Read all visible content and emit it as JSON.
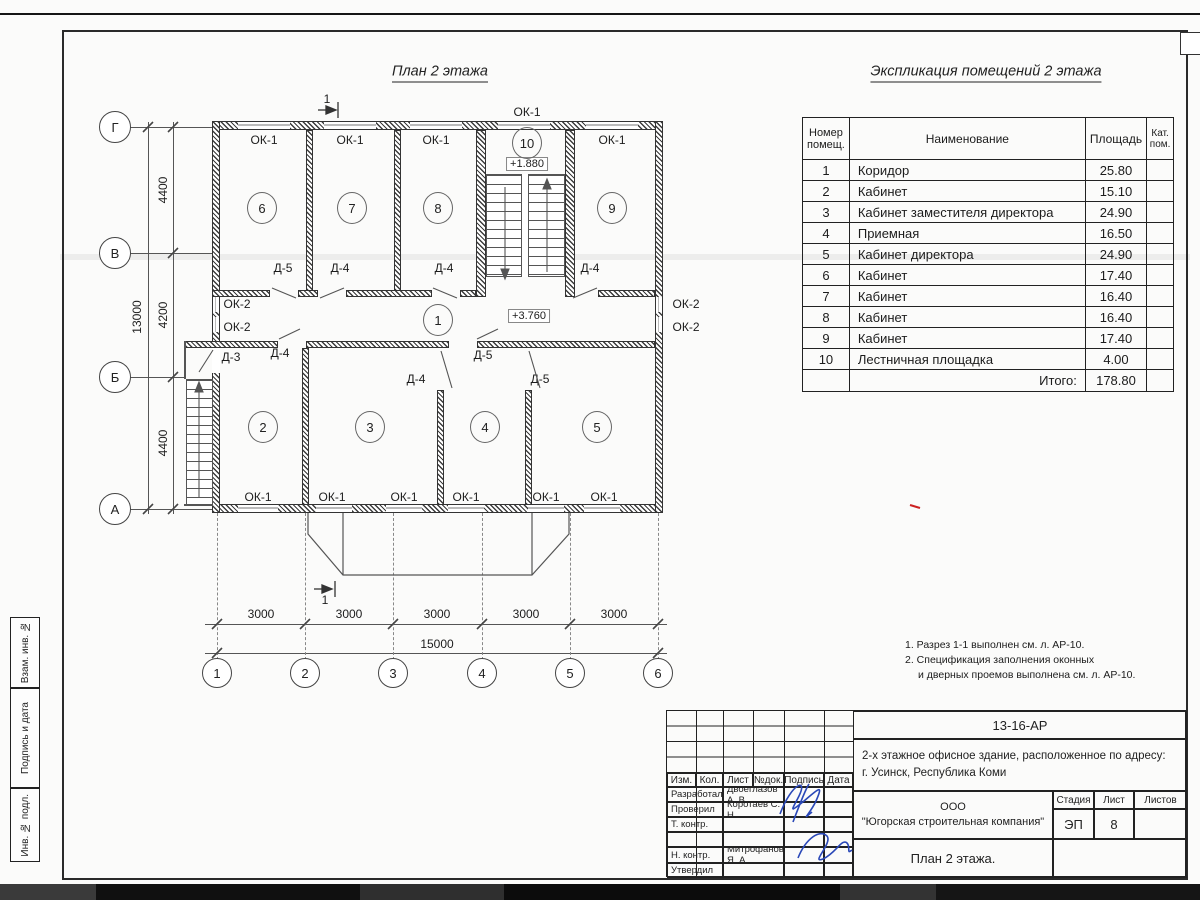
{
  "sheet": {
    "plan_title": "План 2 этажа",
    "table_title": "Экспликация помещений 2 этажа",
    "notes_line1": "1. Разрез 1-1 выполнен см. л. АР-10.",
    "notes_line2": "2. Спецификация заполнения оконных",
    "notes_line3": "и дверных проемов выполнена см. л. АР-10.",
    "margin_stamps": [
      "Взам. инв. №",
      "Подпись и дата",
      "Инв. № подл."
    ],
    "accent_colors": {
      "signature_blue": "#2a48b8",
      "correction_red": "#cc2222",
      "line_dark": "#222222"
    }
  },
  "explication": {
    "headers": {
      "num": "Номер помещ.",
      "name": "Наименование",
      "area": "Площадь",
      "cat": "Кат. пом."
    },
    "rows": [
      {
        "num": "1",
        "name": "Коридор",
        "area": "25.80"
      },
      {
        "num": "2",
        "name": "Кабинет",
        "area": "15.10"
      },
      {
        "num": "3",
        "name": "Кабинет заместителя директора",
        "area": "24.90"
      },
      {
        "num": "4",
        "name": "Приемная",
        "area": "16.50"
      },
      {
        "num": "5",
        "name": "Кабинет директора",
        "area": "24.90"
      },
      {
        "num": "6",
        "name": "Кабинет",
        "area": "17.40"
      },
      {
        "num": "7",
        "name": "Кабинет",
        "area": "16.40"
      },
      {
        "num": "8",
        "name": "Кабинет",
        "area": "16.40"
      },
      {
        "num": "9",
        "name": "Кабинет",
        "area": "17.40"
      },
      {
        "num": "10",
        "name": "Лестничная площадка",
        "area": "4.00"
      }
    ],
    "total_label": "Итого:",
    "total_value": "178.80"
  },
  "plan": {
    "labels": [
      {
        "t": "ОК-1",
        "x": 264,
        "y": 140
      },
      {
        "t": "ОК-1",
        "x": 350,
        "y": 140
      },
      {
        "t": "ОК-1",
        "x": 436,
        "y": 140
      },
      {
        "t": "ОК-1",
        "x": 612,
        "y": 140
      },
      {
        "t": "ОК-1",
        "x": 527,
        "y": 112
      },
      {
        "t": "ОК-1",
        "x": 258,
        "y": 497
      },
      {
        "t": "ОК-1",
        "x": 332,
        "y": 497
      },
      {
        "t": "ОК-1",
        "x": 404,
        "y": 497
      },
      {
        "t": "ОК-1",
        "x": 466,
        "y": 497
      },
      {
        "t": "ОК-1",
        "x": 546,
        "y": 497
      },
      {
        "t": "ОК-1",
        "x": 604,
        "y": 497
      },
      {
        "t": "ОК-2",
        "x": 237,
        "y": 304
      },
      {
        "t": "ОК-2",
        "x": 237,
        "y": 327
      },
      {
        "t": "ОК-2",
        "x": 686,
        "y": 304
      },
      {
        "t": "ОК-2",
        "x": 686,
        "y": 327
      },
      {
        "t": "Д-5",
        "x": 283,
        "y": 268
      },
      {
        "t": "Д-4",
        "x": 340,
        "y": 268
      },
      {
        "t": "Д-4",
        "x": 444,
        "y": 268
      },
      {
        "t": "Д-4",
        "x": 590,
        "y": 268
      },
      {
        "t": "Д-3",
        "x": 231,
        "y": 357
      },
      {
        "t": "Д-4",
        "x": 280,
        "y": 353
      },
      {
        "t": "Д-4",
        "x": 416,
        "y": 379
      },
      {
        "t": "Д-5",
        "x": 483,
        "y": 355
      },
      {
        "t": "Д-5",
        "x": 540,
        "y": 379
      },
      {
        "t": "1",
        "x": 327,
        "y": 99
      },
      {
        "t": "1",
        "x": 325,
        "y": 600
      },
      {
        "t": "3000",
        "x": 261,
        "y": 614
      },
      {
        "t": "3000",
        "x": 349,
        "y": 614
      },
      {
        "t": "3000",
        "x": 437,
        "y": 614
      },
      {
        "t": "3000",
        "x": 526,
        "y": 614
      },
      {
        "t": "3000",
        "x": 614,
        "y": 614
      },
      {
        "t": "15000",
        "x": 437,
        "y": 644
      }
    ],
    "rotated_dims": [
      {
        "t": "4400",
        "x": 163,
        "y": 190
      },
      {
        "t": "4200",
        "x": 163,
        "y": 315
      },
      {
        "t": "4400",
        "x": 163,
        "y": 443
      },
      {
        "t": "13000",
        "x": 137,
        "y": 317
      }
    ],
    "elevations": [
      {
        "t": "+1.880",
        "x": 527,
        "y": 164
      },
      {
        "t": "+3.760",
        "x": 529,
        "y": 316
      }
    ],
    "rooms": [
      {
        "n": "6",
        "x": 262,
        "y": 208
      },
      {
        "n": "7",
        "x": 352,
        "y": 208
      },
      {
        "n": "8",
        "x": 438,
        "y": 208
      },
      {
        "n": "9",
        "x": 612,
        "y": 208
      },
      {
        "n": "10",
        "x": 527,
        "y": 143
      },
      {
        "n": "1",
        "x": 438,
        "y": 320
      },
      {
        "n": "2",
        "x": 263,
        "y": 427
      },
      {
        "n": "3",
        "x": 370,
        "y": 427
      },
      {
        "n": "4",
        "x": 485,
        "y": 427
      },
      {
        "n": "5",
        "x": 597,
        "y": 427
      }
    ],
    "axes_bottom": [
      {
        "n": "1",
        "x": 217
      },
      {
        "n": "2",
        "x": 305
      },
      {
        "n": "3",
        "x": 393
      },
      {
        "n": "4",
        "x": 482
      },
      {
        "n": "5",
        "x": 570
      },
      {
        "n": "6",
        "x": 658
      }
    ],
    "axes_left": [
      {
        "n": "Г",
        "y": 127
      },
      {
        "n": "В",
        "y": 253
      },
      {
        "n": "Б",
        "y": 377
      },
      {
        "n": "А",
        "y": 509
      }
    ]
  },
  "titleblock": {
    "doc_code": "13-16-АР",
    "description_line1": "2-х этажное офисное здание, расположенное по адресу:",
    "description_line2": "г. Усинск, Республика Коми",
    "company_line1": "ООО",
    "company_line2": "\"Югорская строительная компания\"",
    "drawing_name": "План 2 этажа.",
    "stage_label": "Стадия",
    "sheet_label": "Лист",
    "sheets_label": "Листов",
    "stage_value": "ЭП",
    "sheet_value": "8",
    "sheets_value": "",
    "cols": [
      "Изм.",
      "Кол.",
      "Лист",
      "№док.",
      "Подпись",
      "Дата"
    ],
    "roles": [
      {
        "role": "Разработал",
        "name": "Двоеглазов А. В."
      },
      {
        "role": "Проверил",
        "name": "Коротаев С. Н."
      },
      {
        "role": "Т. контр.",
        "name": ""
      },
      {
        "role": "",
        "name": ""
      },
      {
        "role": "Н. контр.",
        "name": "Митрофанов Я. А."
      },
      {
        "role": "Утвердил",
        "name": ""
      }
    ]
  }
}
